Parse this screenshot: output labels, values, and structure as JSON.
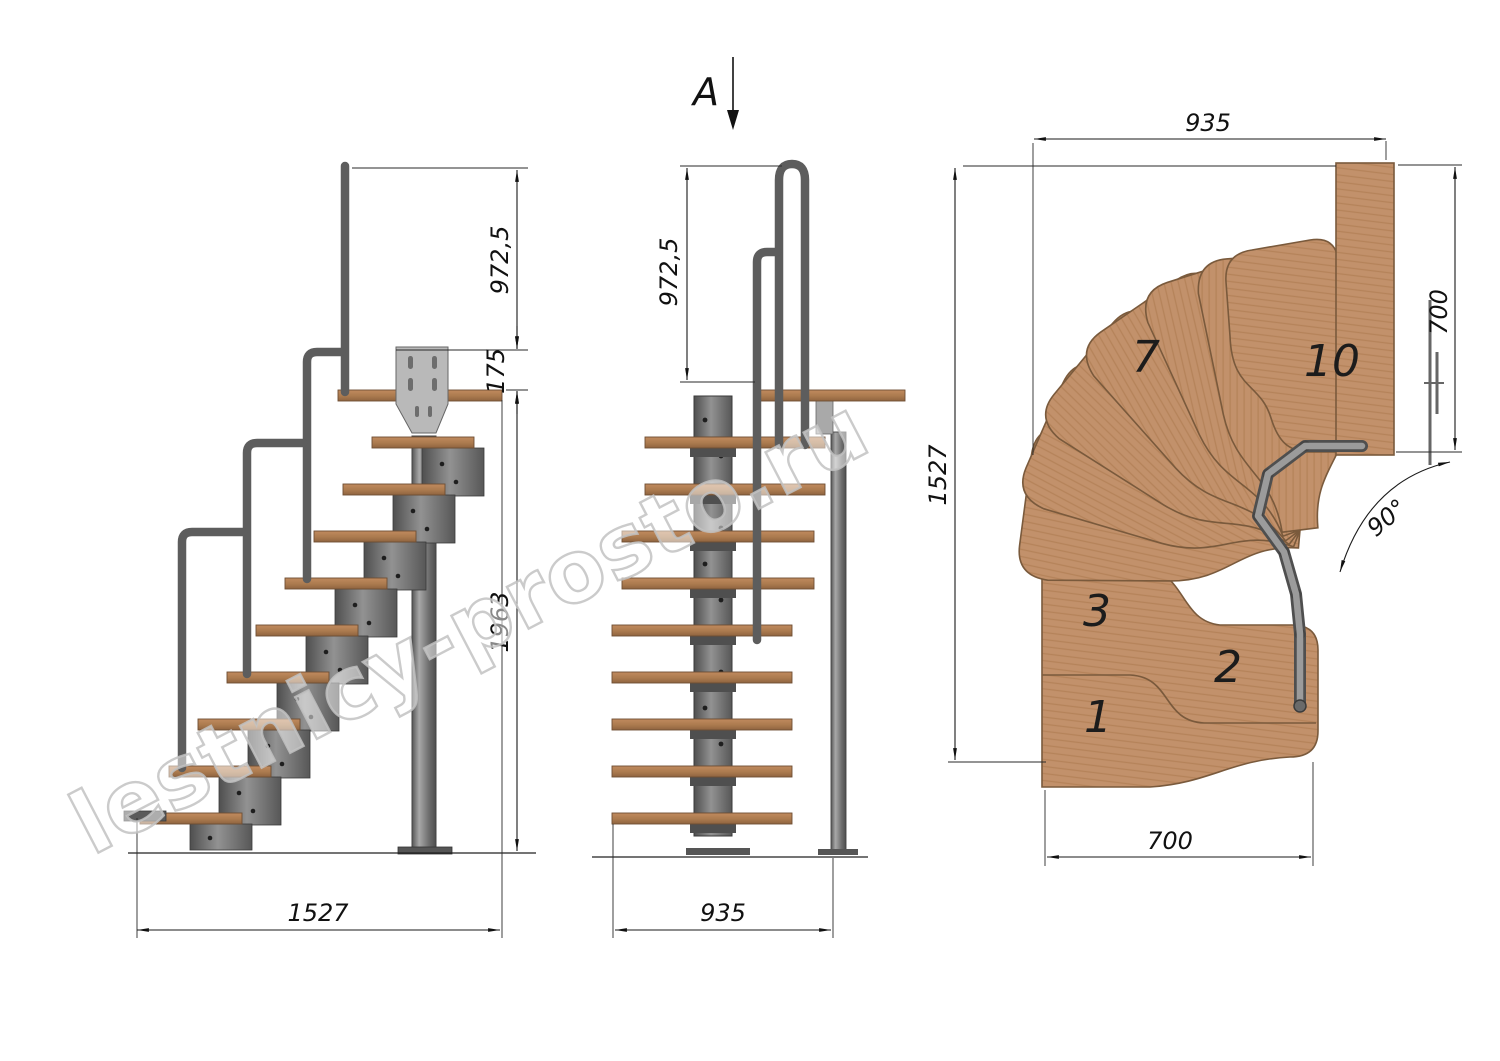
{
  "title": "Modular staircase technical drawing with 90 degree turn",
  "watermark": "lestnicy-prosto.ru",
  "section_label": "A",
  "views": {
    "side": {
      "dims": {
        "rail_height": "972,5",
        "landing_drop": "175",
        "floor_height": "1963",
        "run_length": "1527"
      }
    },
    "front": {
      "dims": {
        "rail_height": "972,5",
        "width": "935"
      }
    },
    "plan": {
      "dims": {
        "top_width": "935",
        "left_depth": "1527",
        "wall_side": "700",
        "bottom_width": "700",
        "turn_angle": "90°"
      },
      "step_labels": [
        "1",
        "2",
        "3",
        "7",
        "10"
      ]
    }
  },
  "colors": {
    "wood": "#c2916b",
    "wood_edge": "#7a5a3c",
    "metal": "#787878",
    "plate": "#b9b9b9",
    "dim_line": "#1a1a1a",
    "watermark_gray": "#c2c2c2",
    "background": "#ffffff"
  }
}
